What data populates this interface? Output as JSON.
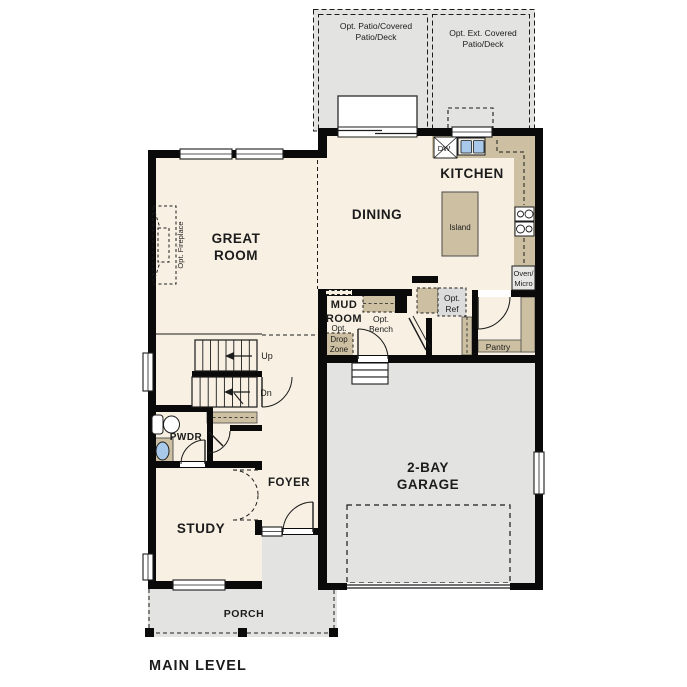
{
  "title": "MAIN LEVEL",
  "colors": {
    "floor": "#f7f0e3",
    "counter": "#cdc0a2",
    "exterior_gray": "#e3e3e1",
    "wall": "#0a0a0a",
    "sink_blue": "#a9c9ea",
    "appliance_gray": "#dcdcdc"
  },
  "labels": {
    "patio_left_1": "Opt. Patio/Covered",
    "patio_left_2": "Patio/Deck",
    "patio_right_1": "Opt. Ext. Covered",
    "patio_right_2": "Patio/Deck",
    "kitchen": "KITCHEN",
    "dining": "DINING",
    "great_1": "GREAT",
    "great_2": "ROOM",
    "island": "Island",
    "dw": "DW",
    "oven_1": "Oven/",
    "oven_2": "Micro",
    "mud_1": "MUD",
    "mud_2": "ROOM",
    "bench_1": "Opt.",
    "bench_2": "Bench",
    "ref_1": "Opt.",
    "ref_2": "Ref",
    "drop_1": "Opt.",
    "drop_2": "Drop",
    "drop_3": "Zone",
    "pantry": "Pantry",
    "garage_1": "2-BAY",
    "garage_2": "GARAGE",
    "up": "Up",
    "dn": "Dn",
    "pwdr": "PWDR",
    "foyer": "FOYER",
    "study": "STUDY",
    "porch": "PORCH",
    "fireplace": "Opt. Fireplace",
    "main_level": "MAIN LEVEL"
  }
}
